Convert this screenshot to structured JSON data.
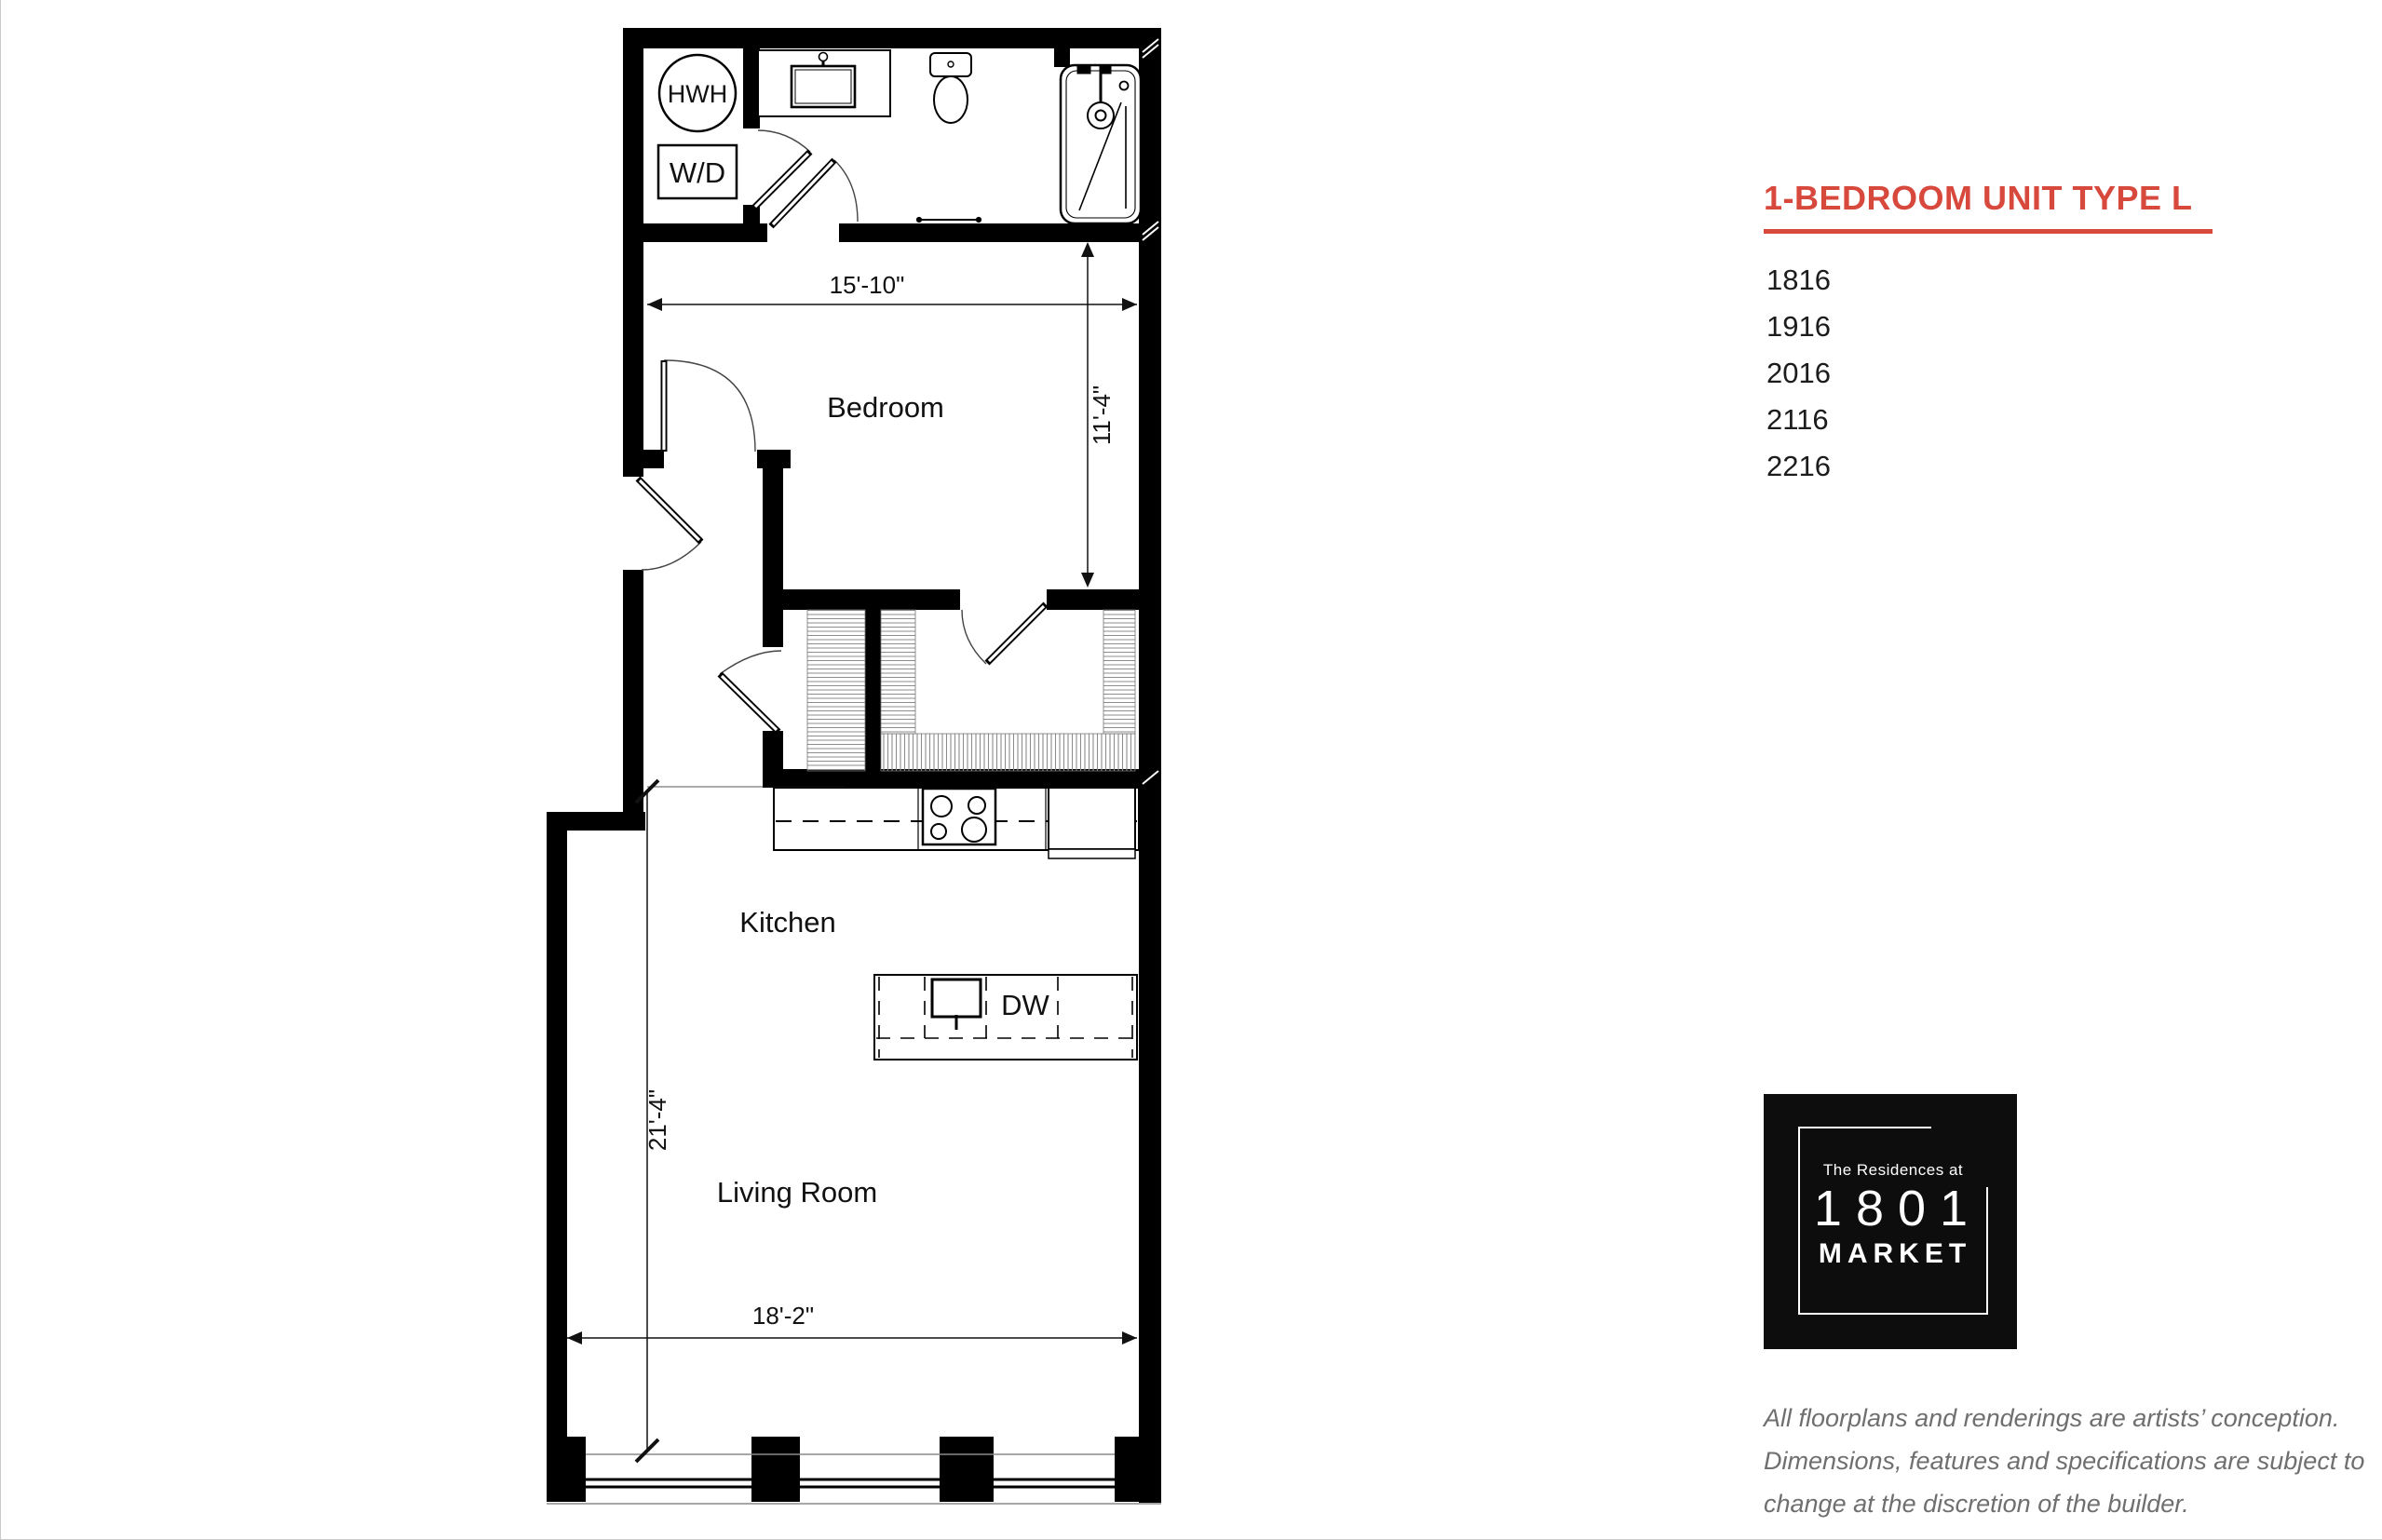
{
  "colors": {
    "accent_red": "#d8493d",
    "logo_background": "#0d0d0d",
    "disclaimer_gray": "#6f6f6f",
    "plan_line": "#000000"
  },
  "header": {
    "title": "1-BEDROOM UNIT TYPE L"
  },
  "unit_numbers": [
    "1816",
    "1916",
    "2016",
    "2116",
    "2216"
  ],
  "plan": {
    "rooms": {
      "bedroom": "Bedroom",
      "kitchen": "Kitchen",
      "living_room": "Living Room"
    },
    "labels": {
      "hot_water_heater": "HWH",
      "washer_dryer": "W/D",
      "dishwasher": "DW"
    },
    "dimensions": {
      "bedroom_width": "15'-10\"",
      "bedroom_depth": "11'-4\"",
      "living_depth": "21'-4\"",
      "living_width": "18'-2\""
    }
  },
  "logo": {
    "tagline": "The Residences at",
    "number": "1801",
    "name": "MARKET"
  },
  "disclaimer": "All floorplans and renderings are artists’ conception. Dimensions, features and specifications are subject to change at the discretion of the builder."
}
